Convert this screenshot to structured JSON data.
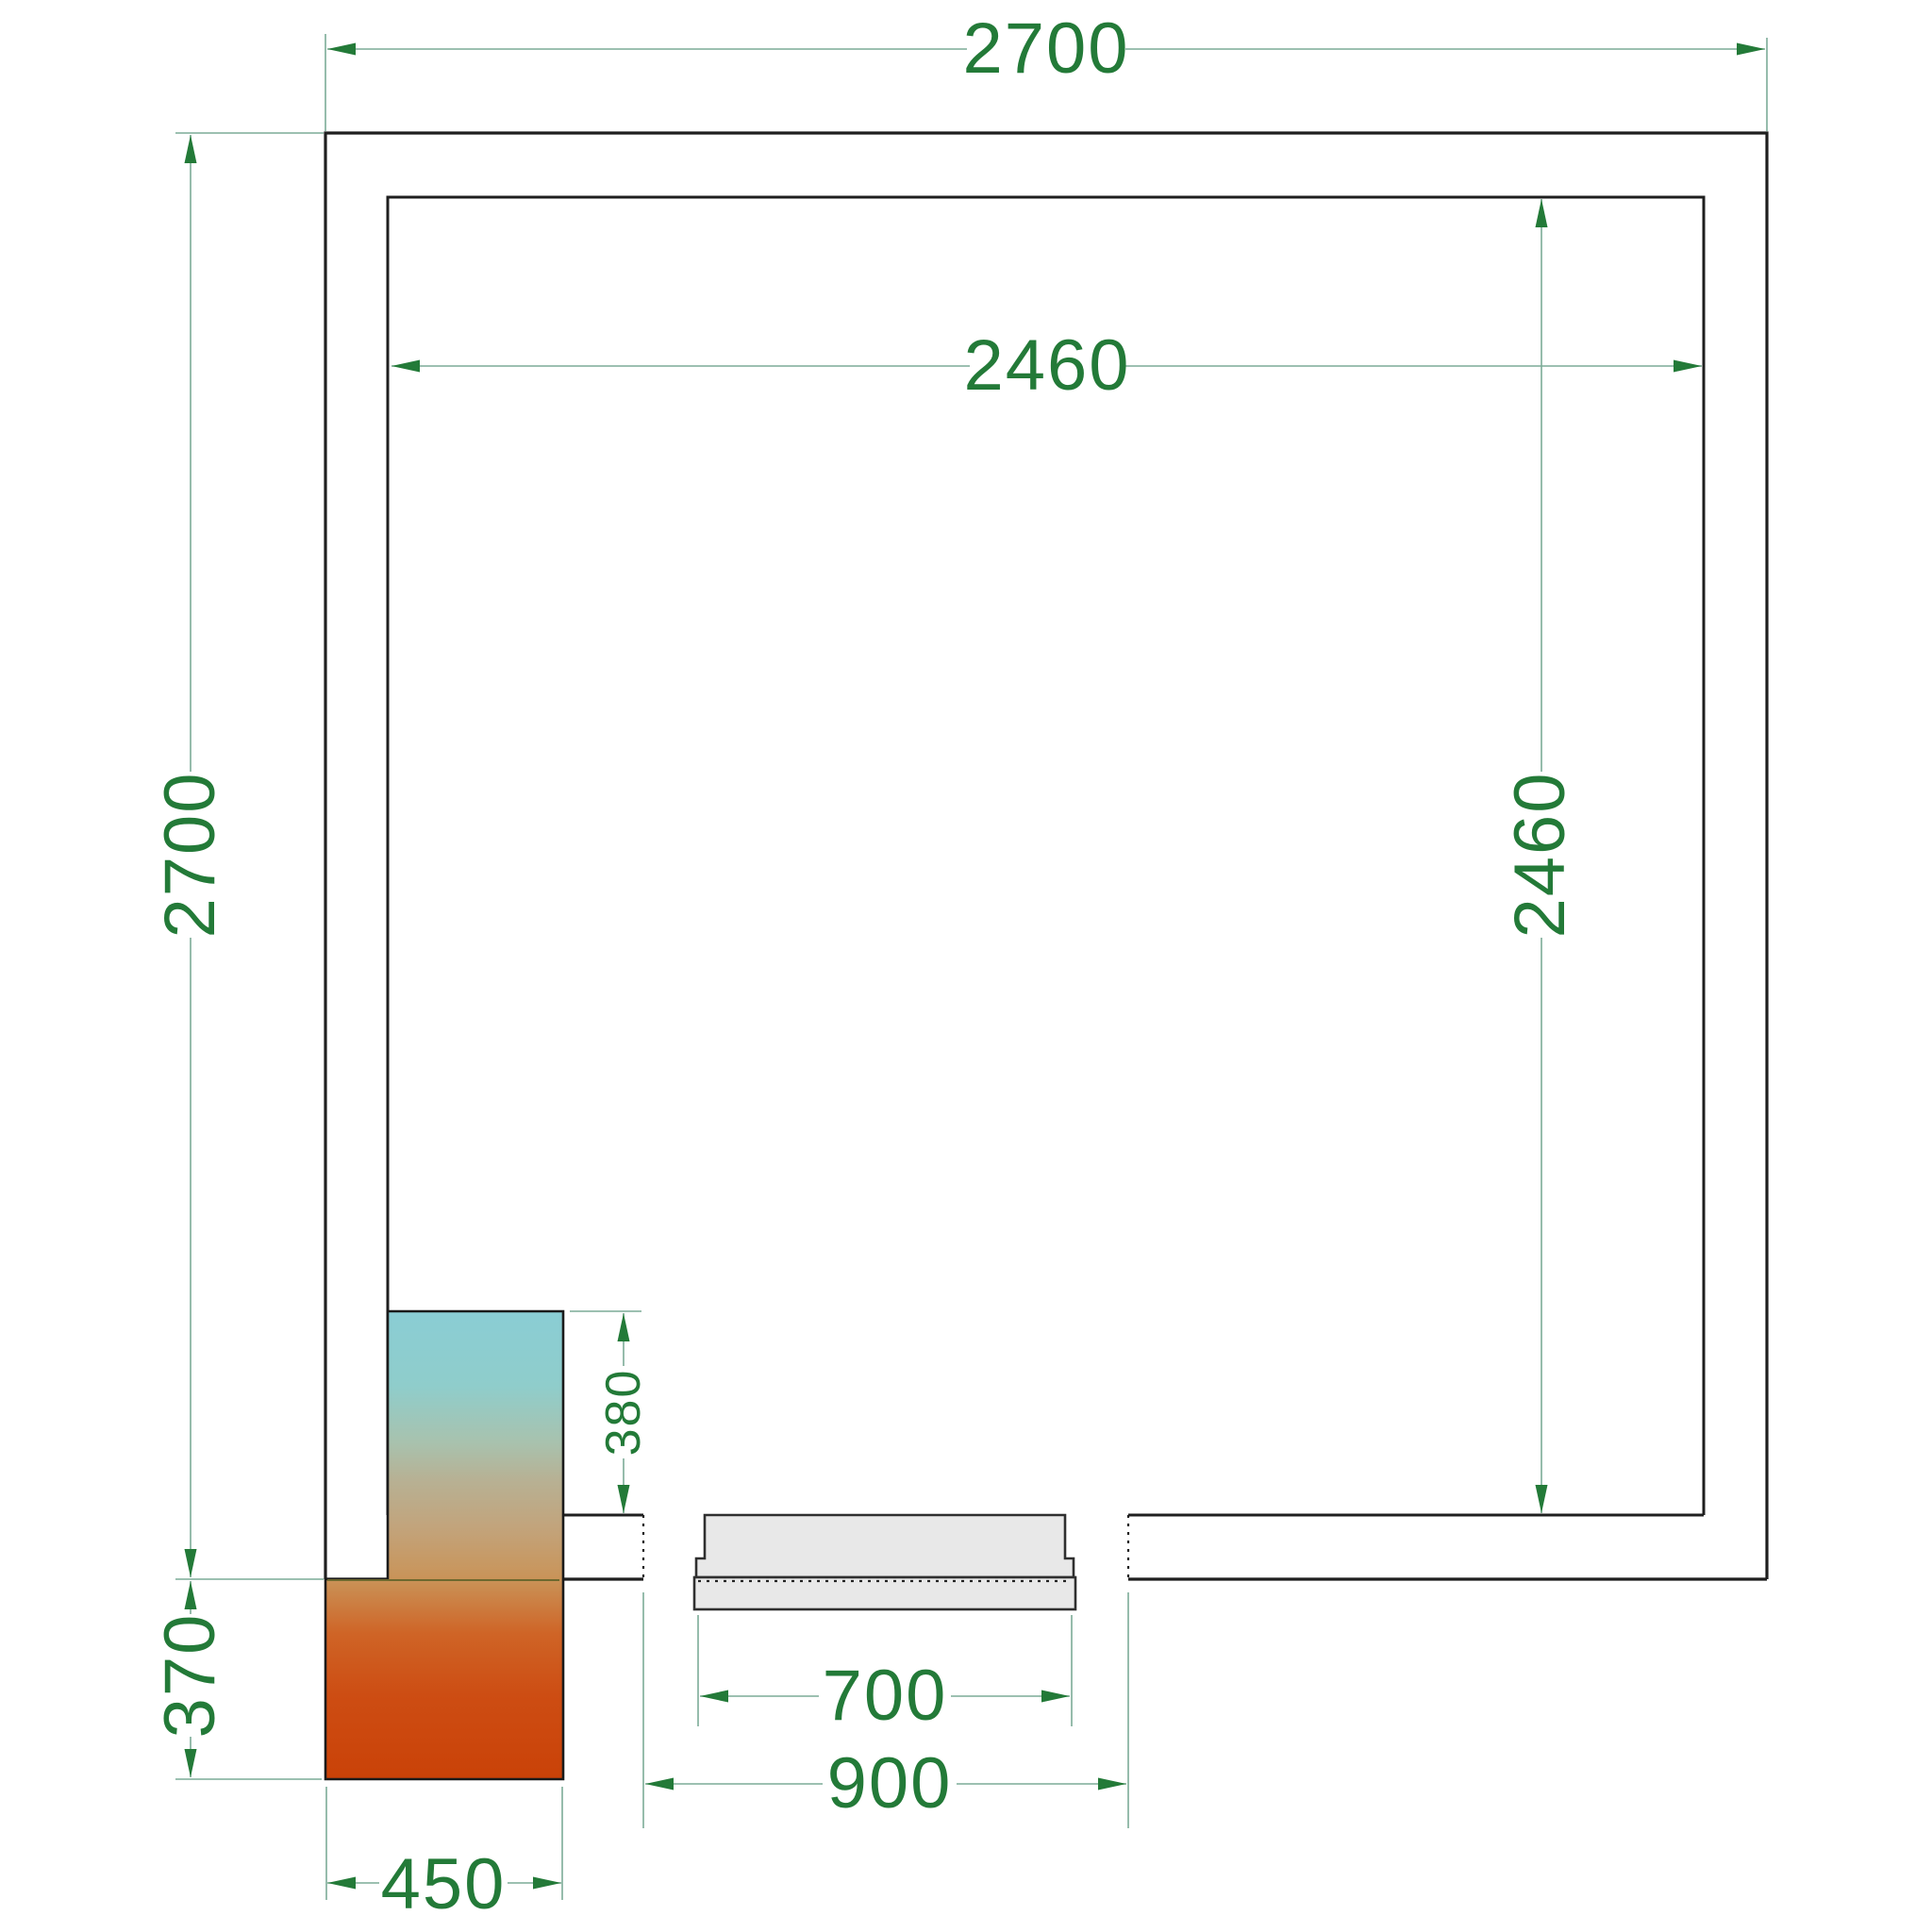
{
  "drawing": {
    "type": "floor-plan",
    "dimensions": {
      "outer_width": "2700",
      "outer_height": "2700",
      "inner_width": "2460",
      "inner_height": "2460",
      "unit_recess": "380",
      "unit_protrusion": "370",
      "unit_width": "450",
      "door_leaf_width": "700",
      "door_opening_width": "900"
    },
    "colors": {
      "dimension_text": "#237a38",
      "dimension_arrow": "#237a38",
      "dimension_line": "#7cab97",
      "wall_line": "#1f1f1f",
      "door_fill": "#e8e8e8",
      "door_border": "#2f2f2f",
      "hidden_line": "#222222",
      "wall_edge_over_gradient": "#6d682f",
      "gradient_top": "#8ecdd2",
      "gradient_mid": "#c2a47c",
      "gradient_bottom": "#ca4208"
    }
  }
}
